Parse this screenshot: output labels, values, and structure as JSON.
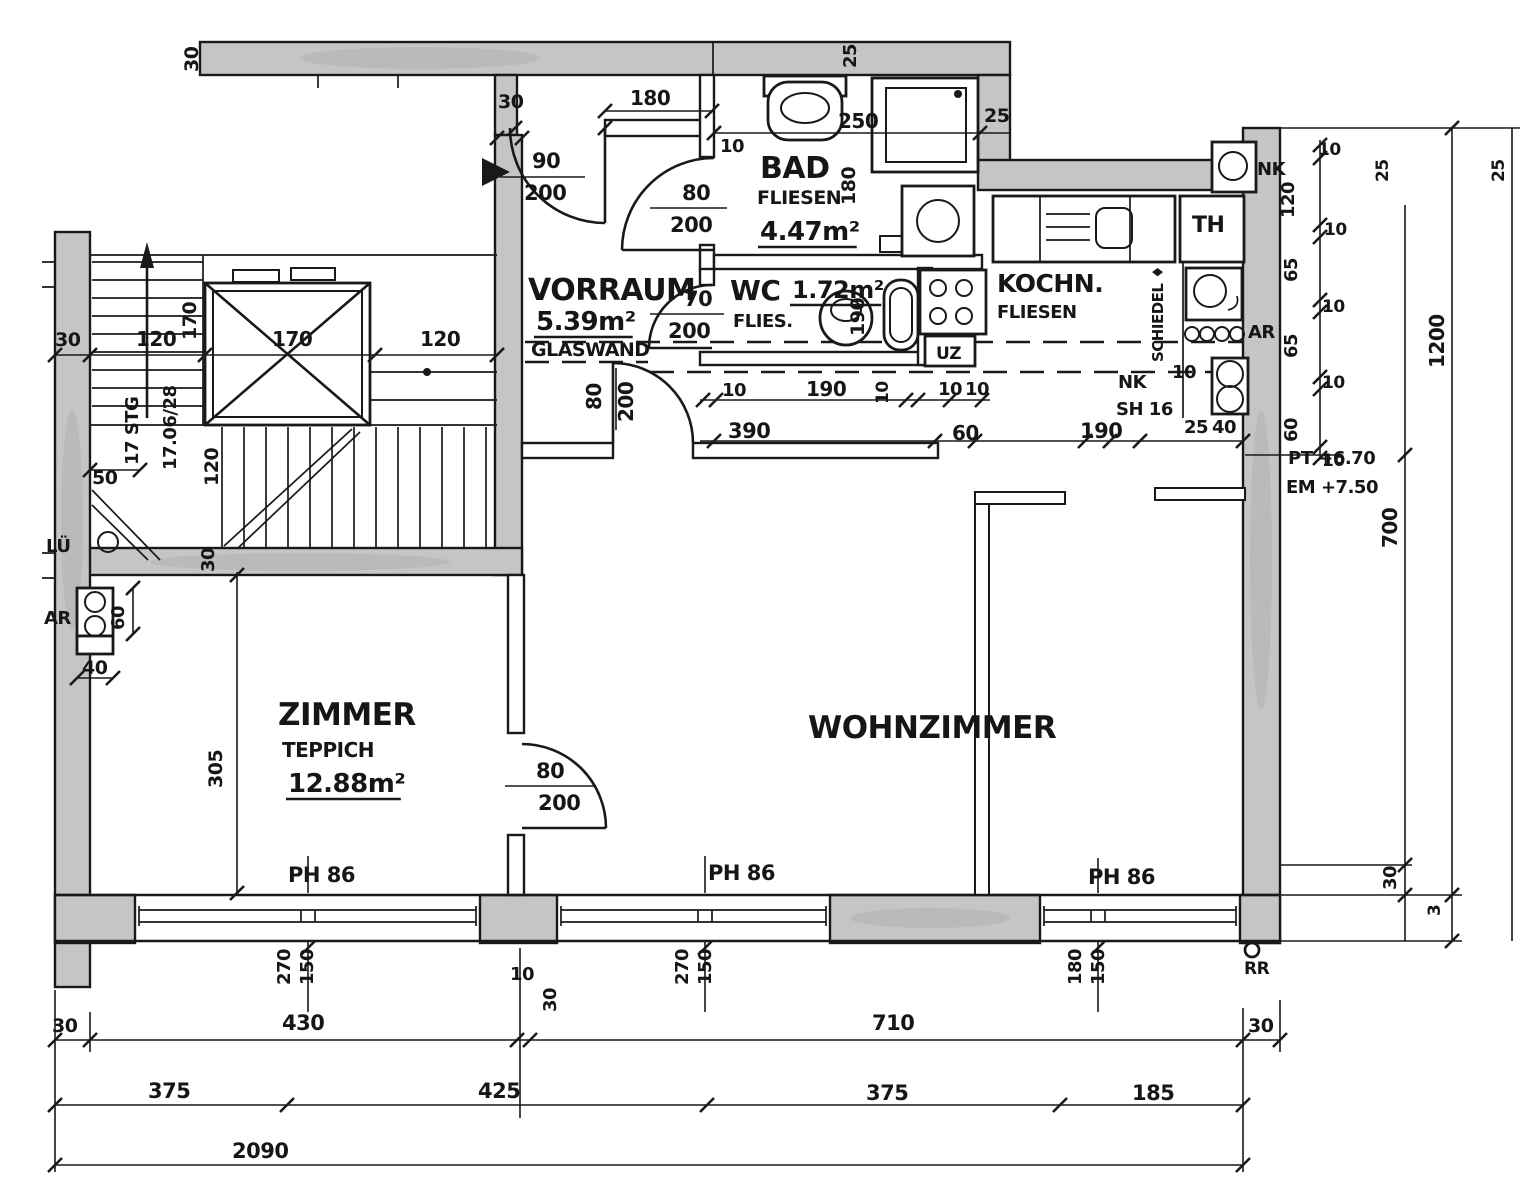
{
  "drawing": {
    "type": "architectural-floor-plan",
    "background": "#ffffff",
    "ink": "#191919",
    "wall_fill": "#c5c5c5",
    "texts": [
      {
        "name": "room-vorraum-name",
        "text": "VORRAUM",
        "x": 528,
        "y": 300,
        "size": 30
      },
      {
        "name": "room-vorraum-area",
        "text": "5.39m²",
        "x": 536,
        "y": 330,
        "size": 26,
        "ul": true
      },
      {
        "name": "room-vorraum-glaswand",
        "text": "GLASWAND",
        "x": 531,
        "y": 356,
        "size": 19
      },
      {
        "name": "room-bad-name",
        "text": "BAD",
        "x": 760,
        "y": 178,
        "size": 30
      },
      {
        "name": "room-bad-finish",
        "text": "FLIESEN",
        "x": 757,
        "y": 204,
        "size": 19
      },
      {
        "name": "room-bad-area",
        "text": "4.47m²",
        "x": 760,
        "y": 240,
        "size": 26,
        "ul": true
      },
      {
        "name": "room-wc-name",
        "text": "WC",
        "x": 730,
        "y": 300,
        "size": 28
      },
      {
        "name": "room-wc-area",
        "text": "1.72m²",
        "x": 792,
        "y": 298,
        "size": 24,
        "ul": true
      },
      {
        "name": "room-wc-finish",
        "text": "FLIES.",
        "x": 733,
        "y": 327,
        "size": 18
      },
      {
        "name": "room-kochnische-name",
        "text": "KOCHN.",
        "x": 997,
        "y": 292,
        "size": 25
      },
      {
        "name": "room-kochnische-finish",
        "text": "FLIESEN",
        "x": 997,
        "y": 318,
        "size": 18
      },
      {
        "name": "room-th-name",
        "text": "TH",
        "x": 1192,
        "y": 232,
        "size": 22
      },
      {
        "name": "room-zimmer-name",
        "text": "ZIMMER",
        "x": 278,
        "y": 725,
        "size": 31
      },
      {
        "name": "room-zimmer-finish",
        "text": "TEPPICH",
        "x": 282,
        "y": 757,
        "size": 20
      },
      {
        "name": "room-zimmer-area",
        "text": "12.88m²",
        "x": 288,
        "y": 792,
        "size": 26,
        "ul": true
      },
      {
        "name": "room-wohnzimmer-name",
        "text": "WOHNZIMMER",
        "x": 808,
        "y": 738,
        "size": 31
      },
      {
        "name": "label-nk-corner",
        "text": "NK",
        "x": 1257,
        "y": 175,
        "size": 18
      },
      {
        "name": "label-ar-kitchen",
        "text": "AR",
        "x": 1248,
        "y": 338,
        "size": 18
      },
      {
        "name": "label-schiedel-flue",
        "text": "SCHIEDEL ♦",
        "x": 1163,
        "y": 362,
        "rot": -90,
        "size": 15
      },
      {
        "name": "label-nk-kitchen",
        "text": "NK",
        "x": 1118,
        "y": 388,
        "size": 18
      },
      {
        "name": "label-sh16",
        "text": "SH 16",
        "x": 1116,
        "y": 415,
        "size": 18
      },
      {
        "name": "label-uz-beam",
        "text": "UZ",
        "x": 936,
        "y": 359,
        "size": 17
      },
      {
        "name": "label-lueftung",
        "text": "LÜ",
        "x": 46,
        "y": 552,
        "size": 18
      },
      {
        "name": "label-ar-left",
        "text": "AR",
        "x": 44,
        "y": 624,
        "size": 18
      },
      {
        "name": "label-stair-steps",
        "text": "17 STG",
        "x": 138,
        "y": 465,
        "rot": -90,
        "size": 18
      },
      {
        "name": "label-stair-rise-run",
        "text": "17.06/28",
        "x": 176,
        "y": 470,
        "rot": -90,
        "size": 18
      },
      {
        "name": "label-ph86-zimmer",
        "text": "PH 86",
        "x": 288,
        "y": 882,
        "size": 21
      },
      {
        "name": "label-ph86-mitte",
        "text": "PH 86",
        "x": 708,
        "y": 880,
        "size": 21
      },
      {
        "name": "label-ph86-rechts",
        "text": "PH 86",
        "x": 1088,
        "y": 884,
        "size": 21
      },
      {
        "name": "label-rr",
        "text": "RR",
        "x": 1244,
        "y": 974,
        "size": 17
      },
      {
        "name": "label-level-pt",
        "text": "PT +6.70",
        "x": 1288,
        "y": 464,
        "size": 18
      },
      {
        "name": "label-level-em",
        "text": "EM +7.50",
        "x": 1286,
        "y": 493,
        "size": 18
      },
      {
        "name": "door-entry-width",
        "text": "90",
        "x": 532,
        "y": 168,
        "size": 21
      },
      {
        "name": "door-entry-height",
        "text": "200",
        "x": 524,
        "y": 200,
        "size": 21
      },
      {
        "name": "door-bad-width",
        "text": "80",
        "x": 682,
        "y": 200,
        "size": 21
      },
      {
        "name": "door-bad-height",
        "text": "200",
        "x": 670,
        "y": 232,
        "size": 21
      },
      {
        "name": "door-wc-width",
        "text": "70",
        "x": 684,
        "y": 306,
        "size": 21
      },
      {
        "name": "door-wc-height",
        "text": "200",
        "x": 668,
        "y": 338,
        "size": 21
      },
      {
        "name": "door-vorraum-wz-width",
        "text": "80",
        "x": 601,
        "y": 410,
        "rot": -90,
        "size": 20
      },
      {
        "name": "door-vorraum-wz-height",
        "text": "200",
        "x": 633,
        "y": 422,
        "rot": -90,
        "size": 20
      },
      {
        "name": "door-zimmer-width",
        "text": "80",
        "x": 536,
        "y": 778,
        "size": 21
      },
      {
        "name": "door-zimmer-height",
        "text": "200",
        "x": 538,
        "y": 810,
        "size": 21
      },
      {
        "name": "dim-topband-30",
        "text": "30",
        "x": 198,
        "y": 72,
        "rot": -90,
        "size": 19
      },
      {
        "name": "dim-entry-wall-180",
        "text": "180",
        "x": 630,
        "y": 105,
        "size": 20
      },
      {
        "name": "dim-entry-30",
        "text": "30",
        "x": 498,
        "y": 108,
        "size": 19
      },
      {
        "name": "dim-badwall-10",
        "text": "10",
        "x": 720,
        "y": 152,
        "size": 18
      },
      {
        "name": "dim-bad-250",
        "text": "250",
        "x": 838,
        "y": 128,
        "size": 20
      },
      {
        "name": "dim-shower-25",
        "text": "25",
        "x": 856,
        "y": 68,
        "rot": -90,
        "size": 18
      },
      {
        "name": "dim-step-25",
        "text": "25",
        "x": 984,
        "y": 122,
        "size": 19
      },
      {
        "name": "dim-bad-180",
        "text": "180",
        "x": 855,
        "y": 205,
        "rot": -90,
        "size": 19
      },
      {
        "name": "dim-wc-190",
        "text": "190",
        "x": 864,
        "y": 336,
        "rot": -90,
        "size": 19
      },
      {
        "name": "dim-left-30",
        "text": "30",
        "x": 55,
        "y": 346,
        "size": 19
      },
      {
        "name": "dim-left-120a",
        "text": "120",
        "x": 136,
        "y": 346,
        "size": 20
      },
      {
        "name": "dim-shaft-170v",
        "text": "170",
        "x": 196,
        "y": 340,
        "rot": -90,
        "size": 19
      },
      {
        "name": "dim-shaft-170h",
        "text": "170",
        "x": 272,
        "y": 346,
        "size": 20
      },
      {
        "name": "dim-left-120b",
        "text": "120",
        "x": 420,
        "y": 346,
        "size": 20
      },
      {
        "name": "dim-stair-50",
        "text": "50",
        "x": 92,
        "y": 484,
        "size": 19
      },
      {
        "name": "dim-stair-120",
        "text": "120",
        "x": 218,
        "y": 486,
        "rot": -90,
        "size": 19
      },
      {
        "name": "dim-stairwall-30",
        "text": "30",
        "x": 214,
        "y": 572,
        "rot": -90,
        "size": 18
      },
      {
        "name": "dim-ar-60",
        "text": "60",
        "x": 124,
        "y": 630,
        "rot": -90,
        "size": 18
      },
      {
        "name": "dim-ar-40",
        "text": "40",
        "x": 82,
        "y": 674,
        "size": 19
      },
      {
        "name": "dim-zimmer-305",
        "text": "305",
        "x": 222,
        "y": 788,
        "rot": -90,
        "size": 19
      },
      {
        "name": "dim-pier-10",
        "text": "10",
        "x": 510,
        "y": 980,
        "size": 18
      },
      {
        "name": "dim-pier-30",
        "text": "30",
        "x": 556,
        "y": 1012,
        "rot": -90,
        "size": 18
      },
      {
        "name": "dim-wcrow-10a",
        "text": "10",
        "x": 722,
        "y": 396,
        "size": 18
      },
      {
        "name": "dim-wcrow-190",
        "text": "190",
        "x": 806,
        "y": 396,
        "size": 20
      },
      {
        "name": "dim-wcrow-10b",
        "text": "10",
        "x": 888,
        "y": 404,
        "rot": -90,
        "size": 17
      },
      {
        "name": "dim-wcrow-10c",
        "text": "10",
        "x": 938,
        "y": 395,
        "size": 18
      },
      {
        "name": "dim-wcrow-10d",
        "text": "10",
        "x": 965,
        "y": 395,
        "size": 18
      },
      {
        "name": "dim-row2-390",
        "text": "390",
        "x": 728,
        "y": 438,
        "size": 21
      },
      {
        "name": "dim-row2-60",
        "text": "60",
        "x": 952,
        "y": 440,
        "size": 20
      },
      {
        "name": "dim-row2-190",
        "text": "190",
        "x": 1080,
        "y": 438,
        "size": 21
      },
      {
        "name": "dim-niche-10",
        "text": "10",
        "x": 1172,
        "y": 378,
        "size": 18
      },
      {
        "name": "dim-row2-25",
        "text": "25",
        "x": 1184,
        "y": 433,
        "size": 18
      },
      {
        "name": "dim-row2-40",
        "text": "40",
        "x": 1212,
        "y": 433,
        "size": 18
      },
      {
        "name": "dim-right-10a",
        "text": "10",
        "x": 1318,
        "y": 155,
        "size": 17
      },
      {
        "name": "dim-right-120",
        "text": "120",
        "x": 1294,
        "y": 218,
        "rot": -90,
        "size": 18
      },
      {
        "name": "dim-right-10b",
        "text": "10",
        "x": 1324,
        "y": 235,
        "size": 17
      },
      {
        "name": "dim-right-25",
        "text": "25",
        "x": 1388,
        "y": 182,
        "rot": -90,
        "size": 17
      },
      {
        "name": "dim-right-65a",
        "text": "65",
        "x": 1297,
        "y": 282,
        "rot": -90,
        "size": 18
      },
      {
        "name": "dim-right-10c",
        "text": "10",
        "x": 1322,
        "y": 312,
        "size": 17
      },
      {
        "name": "dim-right-65b",
        "text": "65",
        "x": 1297,
        "y": 358,
        "rot": -90,
        "size": 18
      },
      {
        "name": "dim-right-10d",
        "text": "10",
        "x": 1322,
        "y": 388,
        "size": 17
      },
      {
        "name": "dim-right-60",
        "text": "60",
        "x": 1297,
        "y": 442,
        "rot": -90,
        "size": 18
      },
      {
        "name": "dim-right-10e",
        "text": "10",
        "x": 1322,
        "y": 466,
        "size": 17
      },
      {
        "name": "dim-total-1200",
        "text": "1200",
        "x": 1444,
        "y": 368,
        "rot": -90,
        "size": 20
      },
      {
        "name": "dim-right-700",
        "text": "700",
        "x": 1397,
        "y": 548,
        "rot": -90,
        "size": 20
      },
      {
        "name": "dim-far-right-25",
        "text": "25",
        "x": 1504,
        "y": 182,
        "rot": -90,
        "size": 17
      },
      {
        "name": "dim-bottomright-30",
        "text": "30",
        "x": 1396,
        "y": 890,
        "rot": -90,
        "size": 18
      },
      {
        "name": "dim-bottomright-3",
        "text": "3",
        "x": 1440,
        "y": 916,
        "rot": -90,
        "size": 17
      },
      {
        "name": "window-zimmer-270",
        "text": "270",
        "x": 290,
        "y": 985,
        "rot": -90,
        "size": 18
      },
      {
        "name": "window-zimmer-150",
        "text": "150",
        "x": 313,
        "y": 985,
        "rot": -90,
        "size": 18
      },
      {
        "name": "window-mitte-270",
        "text": "270",
        "x": 688,
        "y": 985,
        "rot": -90,
        "size": 18
      },
      {
        "name": "window-mitte-150",
        "text": "150",
        "x": 711,
        "y": 985,
        "rot": -90,
        "size": 18
      },
      {
        "name": "window-rechts-180",
        "text": "180",
        "x": 1081,
        "y": 985,
        "rot": -90,
        "size": 18
      },
      {
        "name": "window-rechts-150",
        "text": "150",
        "x": 1104,
        "y": 985,
        "rot": -90,
        "size": 18
      },
      {
        "name": "chain1-30-left",
        "text": "30",
        "x": 52,
        "y": 1032,
        "size": 19
      },
      {
        "name": "chain1-430",
        "text": "430",
        "x": 282,
        "y": 1030,
        "size": 21
      },
      {
        "name": "chain1-710",
        "text": "710",
        "x": 872,
        "y": 1030,
        "size": 21
      },
      {
        "name": "chain1-30-right",
        "text": "30",
        "x": 1248,
        "y": 1032,
        "size": 19
      },
      {
        "name": "chain2-375a",
        "text": "375",
        "x": 148,
        "y": 1098,
        "size": 21
      },
      {
        "name": "chain2-425",
        "text": "425",
        "x": 478,
        "y": 1098,
        "size": 21
      },
      {
        "name": "chain2-375b",
        "text": "375",
        "x": 866,
        "y": 1100,
        "size": 21
      },
      {
        "name": "chain2-185",
        "text": "185",
        "x": 1132,
        "y": 1100,
        "size": 21
      },
      {
        "name": "chain3-2090",
        "text": "2090",
        "x": 232,
        "y": 1158,
        "size": 21
      }
    ]
  }
}
